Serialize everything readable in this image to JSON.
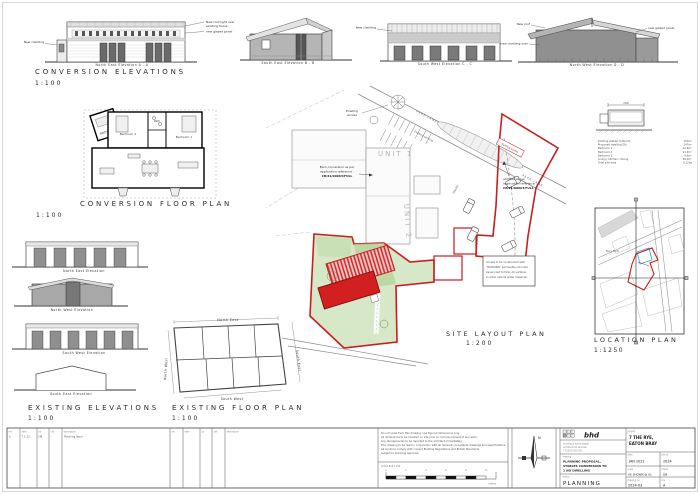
{
  "colors": {
    "boundary_red": "#c81e1e",
    "site_green": "#d6e8c8",
    "building_red": "#d21f1f",
    "map_blue": "#2aa3cc"
  },
  "conv_elev": {
    "title": "CONVERSION ELEVATIONS",
    "scale": "1:100",
    "cap_a": "North East Elevation  A - A",
    "cap_b": "South East Elevation  B - B",
    "cap_c": "South West Elevation  C - C",
    "cap_d": "North West Elevation  D - D",
    "ann_a_left": "New cladding",
    "ann_a_r1": "New roof light over",
    "ann_a_r2": "existing frame",
    "ann_a_r3": "new glazed panel",
    "ann_c": "New cladding",
    "ann_d_l1": "New roof",
    "ann_d_l2": "new cladding over",
    "ann_d_r": "new glazed panel"
  },
  "conv_plan": {
    "title": "CONVERSION FLOOR PLAN",
    "scale": "1:100",
    "bed1": "Bedroom 1",
    "bed2": "Bedroom 2",
    "bed3": "Bedroom 3",
    "bath": "Bath"
  },
  "exist_elev": {
    "title": "EXISTING ELEVATIONS",
    "scale": "1:100",
    "cap_ne": "North East Elevation",
    "cap_nw": "North West Elevation",
    "cap_sw": "South West Elevation",
    "cap_se": "South East Elevation"
  },
  "exist_plan": {
    "title": "EXISTING FLOOR PLAN",
    "scale": "1:100",
    "lbl_ne": "North East",
    "lbl_se": "South East",
    "lbl_nw": "North West",
    "lbl_sw": "South West"
  },
  "site": {
    "title": "SITE LAYOUT PLAN",
    "scale": "1:200",
    "road1": "PARK LANE",
    "road2": "PARK LANE",
    "access1_l1": "Existing",
    "access1_l2": "access",
    "access2": "Existing access",
    "parking": "Existing parking",
    "unit1": "UNIT 1",
    "unit2": "UNIT 2",
    "stables": "Stables",
    "ann_barn_1": "Barn conversion as per",
    "ann_barn_2": "application reference :",
    "ann_barn_3": "CB/21/00063/FULL",
    "ann_access_1": "ACCESS as per",
    "ann_access_2": "application reference :",
    "ann_access_3": "CB/21/00063/FULL",
    "note_1": "Access to be constructed with",
    "note_2": "'TRUEGRID' permeable concrete",
    "note_3": "pavers laid to falls. All surfaces",
    "note_4": "to allow natural water dispersal."
  },
  "location": {
    "title": "LOCATION PLAN",
    "scale": "1:1250",
    "map_label": "Bury Farm"
  },
  "schedule": {
    "dim": "2400",
    "rows": [
      {
        "t": "Existing stables footprint",
        "v": "153m²"
      },
      {
        "t": "Proposed dwelling GIA",
        "v": "147m²"
      },
      {
        "t": "Bedroom 1",
        "v": "12.8m²"
      },
      {
        "t": "Bedroom 2",
        "v": "11.2m²"
      },
      {
        "t": "Bedroom 3",
        "v": "9.6m²"
      },
      {
        "t": "Living / kitchen / dining",
        "v": "48.0m²"
      },
      {
        "t": "Total site area",
        "v": "0.12ha"
      }
    ]
  },
  "notes": {
    "lines": [
      "Do not scale from this drawing. Use figured dimensions only.",
      "All dimensions to be checked on site prior to commencement of any work.",
      "Any discrepancies to be reported to the architect immediately.",
      "This drawing to be read in conjunction with all relevant consultants drawings and specifications.",
      "All works to comply with current Building Regulations and British Standards.",
      "Subject to planning approval."
    ],
    "scale_title": "SCALE BAR 1:200",
    "units": "metres",
    "ticks": [
      "0",
      "2",
      "4",
      "6",
      "8",
      "10"
    ]
  },
  "north": {
    "label": "N"
  },
  "revisions": {
    "h_rev": "rev",
    "h_date": "date",
    "h_by": "by",
    "h_chk": "chk",
    "h_desc": "description",
    "row": {
      "rev": "A",
      "date": "7.1.22",
      "by": "DB",
      "chk": "-",
      "desc": "Planning issue"
    }
  },
  "title_block": {
    "logo": "bhd",
    "firm_1": "building & home design",
    "firm_2": "architectural services",
    "firm_3": "T 01525 000 000",
    "project_label": "project",
    "project_1": "7 THE RYE,",
    "project_2": "EATON BRAY",
    "drawing_label": "drawing",
    "drawing_1": "PLANNING PROPOSAL,",
    "drawing_2": "STABLES CONVERSION TO",
    "drawing_3": "1 NO DWELLING",
    "status_label": "status",
    "status": "PLANNING",
    "date_label": "date",
    "date": "JAN 2022",
    "job_label": "job no",
    "job": "2024",
    "scale_label": "scale",
    "scale": "AS SHOWN @ A1",
    "drawn_label": "drawn",
    "drawn": "DB",
    "dwgno_label": "drawing no",
    "dwgno": "2024-03",
    "rev_label": "rev",
    "rev": "A"
  }
}
